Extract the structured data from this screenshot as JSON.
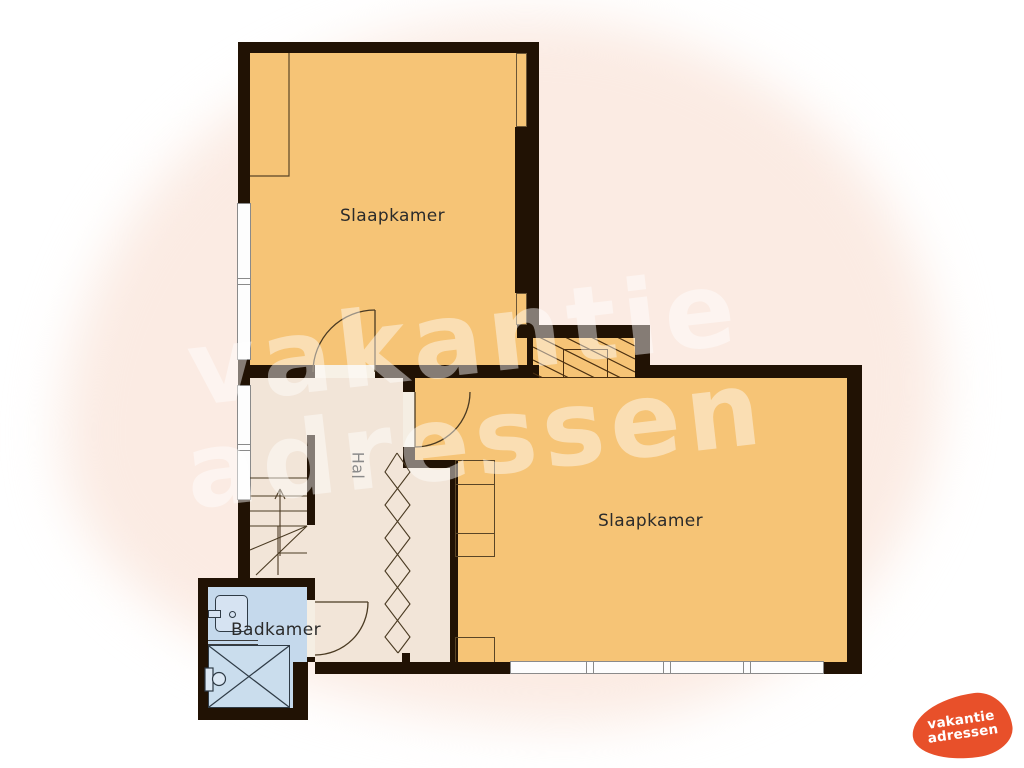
{
  "floorplan": {
    "rooms": [
      {
        "name": "slaapkamer-top",
        "label": "Slaapkamer"
      },
      {
        "name": "slaapkamer-right",
        "label": "Slaapkamer"
      },
      {
        "name": "hal",
        "label": "Hal"
      },
      {
        "name": "badkamer",
        "label": "Badkamer"
      }
    ],
    "watermark": {
      "line1": "vakantie",
      "line2": "adressen"
    },
    "logo": {
      "line1": "vakantie",
      "line2": "adressen"
    },
    "colors": {
      "room_fill": "#f6c476",
      "hall_fill": "#f2e5d8",
      "bathroom_fill": "#c5d9ec",
      "wall": "#211204",
      "background_blob": "#fbebe3",
      "logo_orange": "#e8502a",
      "label_text": "#2b2b2b"
    }
  }
}
